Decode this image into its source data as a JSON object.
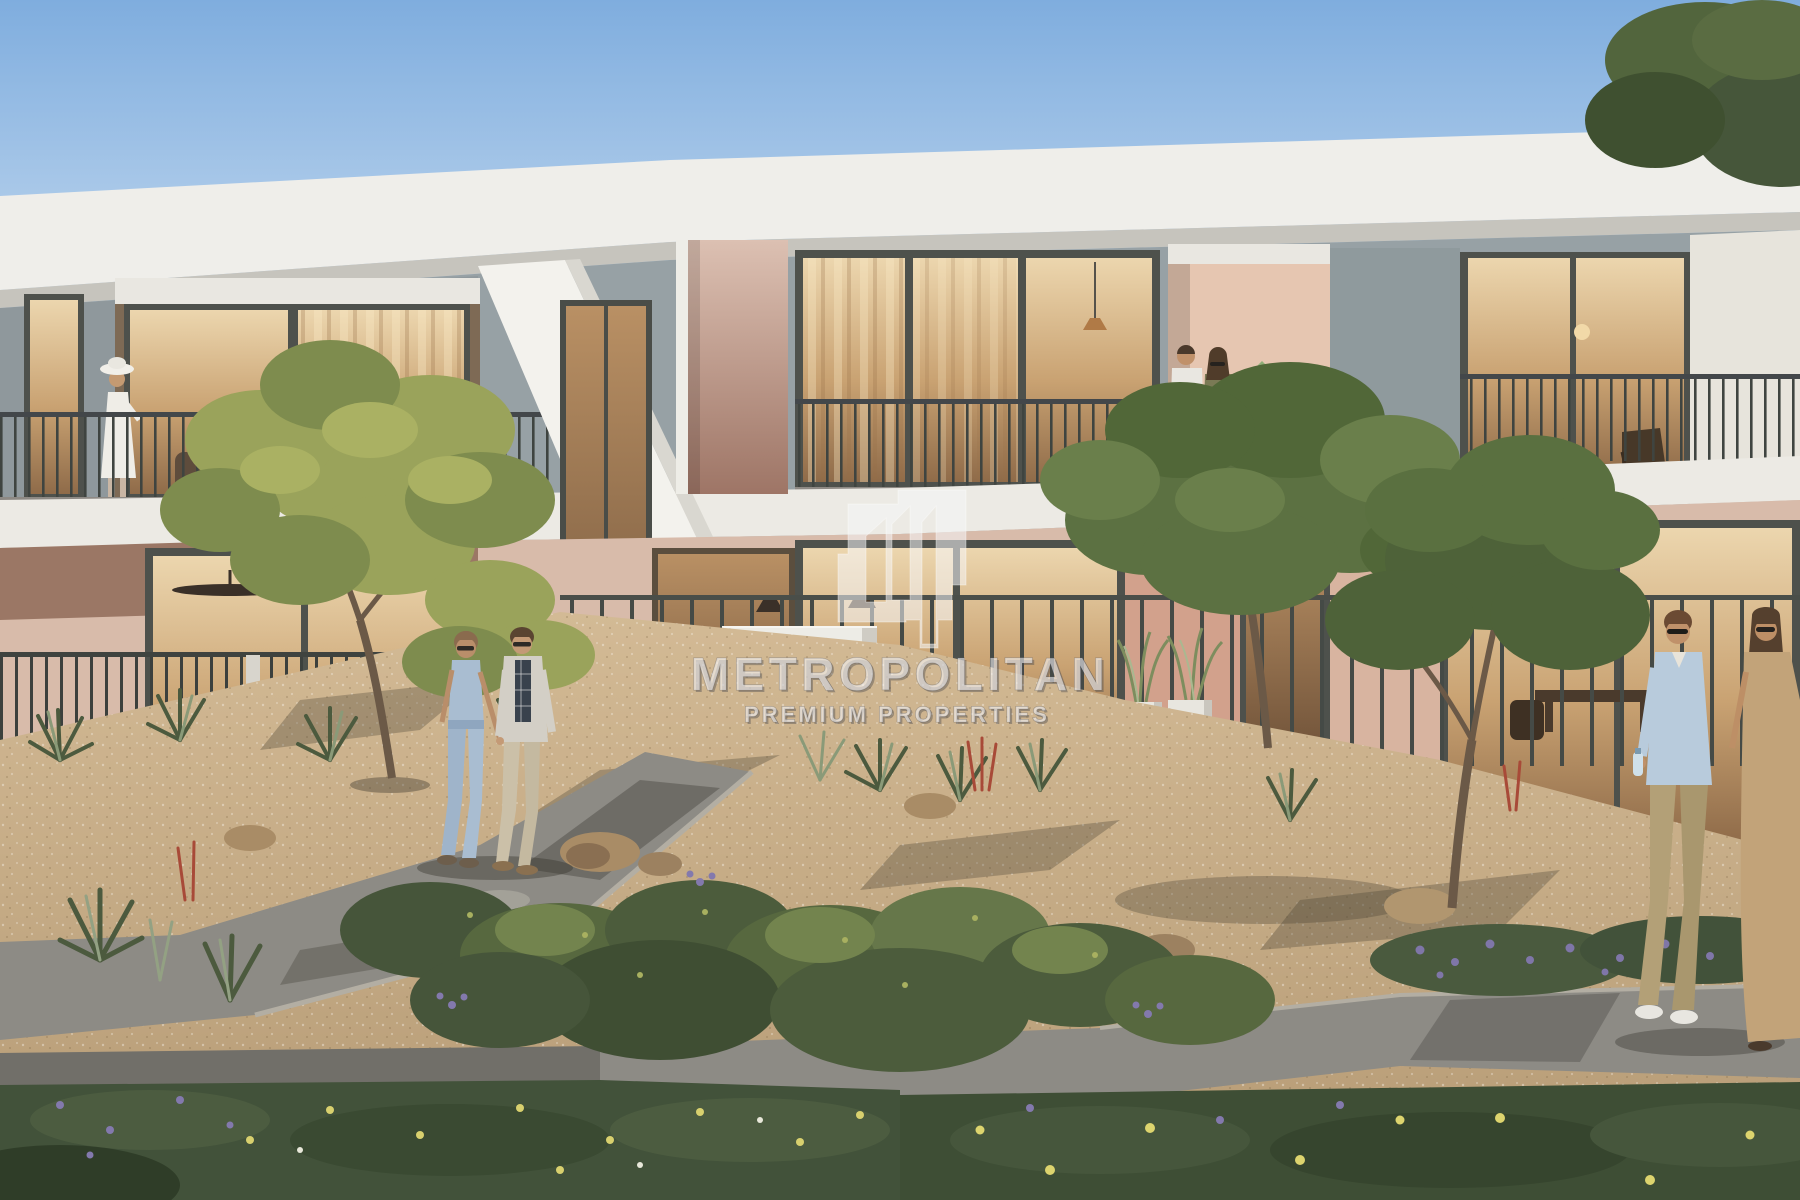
{
  "meta": {
    "type": "architectural-render-photo",
    "subject": "Modern two-storey townhouse community with desert landscaping, garden paths and residents"
  },
  "watermark": {
    "brand": "METROPOLITAN",
    "tagline": "PREMIUM PROPERTIES",
    "logo": "buildings-mark"
  },
  "palette": {
    "sky_top": "#7fadde",
    "sky_horizon": "#c6dbf0",
    "fascia": "#efeeea",
    "upper_wall": "#97a1a5",
    "slab": "#eceae4",
    "mauve_top": "#dcc0b2",
    "mauve_bottom": "#9e7566",
    "brown_band": "#9b7765",
    "pink_wall": "#d8bbaa",
    "glass_top": "#ecd6ae",
    "glass_mid": "#c9a272",
    "glass_bottom": "#8f6b49",
    "gravel_light": "#d3ba95",
    "gravel_dark": "#b59a74",
    "path": "#8d8b85",
    "tree_left_foliage": "#9aa35b",
    "tree_green_foliage": "#5c7142",
    "diamond_green": "#8fae77",
    "diamond_terracotta": "#b8765a",
    "watermark_fill": "rgba(247,247,250,0.58)"
  },
  "people": [
    {
      "id": "balcony-woman",
      "label": "woman in white dress and sun hat on left balcony"
    },
    {
      "id": "balcony-couple",
      "label": "couple talking on right upper balcony"
    },
    {
      "id": "walking-couple-left",
      "label": "couple holding hands on garden path"
    },
    {
      "id": "walking-couple-right",
      "label": "couple walking at right edge"
    }
  ]
}
